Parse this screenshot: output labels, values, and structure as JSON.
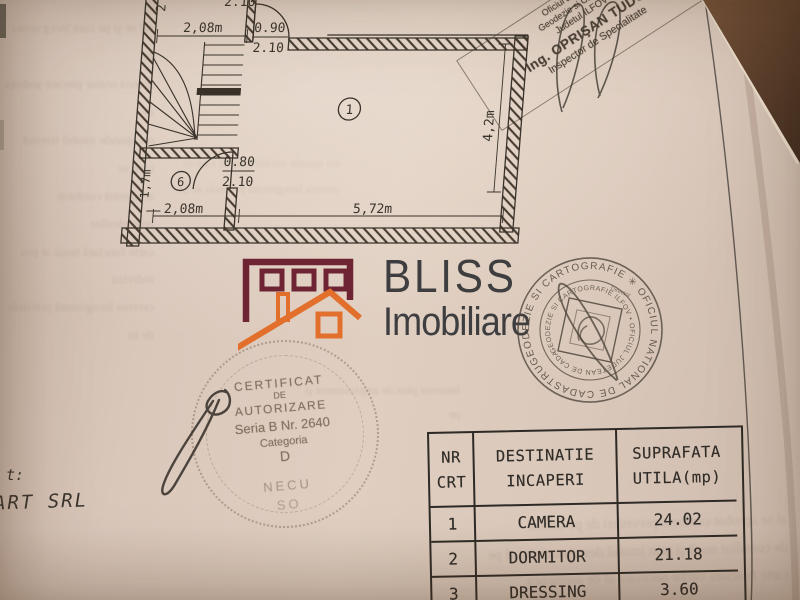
{
  "colors": {
    "paper": "#d8c6b8",
    "table_surface": "#5a3c28",
    "ink": "#3a332b",
    "logo_maroon": "#6e2433",
    "logo_orange": "#e2702c",
    "logo_text": "#3e3d3f"
  },
  "plan": {
    "dim_top_partial": "2.10",
    "dim_top_edge": "2",
    "dim_top_room": "2,08m",
    "door_top_w": "0.90",
    "door_top_h": "2.10",
    "door_hall_w": "0.80",
    "door_hall_h": "2.10",
    "dim_hall_height": "1,7m",
    "dim_bottom_left": "2,08m",
    "dim_bottom_right": "5,72m",
    "dim_right_height": "4,2m",
    "room1_label": "1",
    "room6_label": "6"
  },
  "inspector_stamp": {
    "line1": "Oficiul Judetean",
    "line2": "Geodezie si Cadastru",
    "line3": "Judetul ILFOV",
    "line4": "Ing. OPRIŞAN TUDOR",
    "line5": "Inspector de Specialitate"
  },
  "logo": {
    "brand": "BLISS",
    "subtitle": "Imobiliare"
  },
  "round_stamp": {
    "outer": "GEODEZIE SI CARTOGRAFIE ✳ OFICIUL NATIONAL DE CADASTRU ✳",
    "inner": "GEODEZIE SI CARTOGRAFIE ILFOV • OFICIUL JUDETEAN DE CADASTRU •",
    "director": "Director"
  },
  "certificate_stamp": {
    "l1": "CERTIFICAT",
    "l2": "DE",
    "l3": "AUTORIZARE",
    "l4": "Seria B Nr. 2640",
    "l5": "Categoria",
    "l6": "D",
    "name1": "NECU",
    "name2": "SO"
  },
  "footer": {
    "fragment1": "t:",
    "fragment2": "ART SRL"
  },
  "table": {
    "h1a": "NR",
    "h1b": "CRT",
    "h2a": "DESTINATIE",
    "h2b": "INCAPERI",
    "h3a": "SUPRAFATA",
    "h3b": "UTILA(mp)",
    "rows": [
      {
        "nr": "1",
        "dest": "CAMERA",
        "sup": "24.02"
      },
      {
        "nr": "2",
        "dest": "DORMITOR",
        "sup": "21.18"
      },
      {
        "nr": "3",
        "dest": "DRESSING",
        "sup": "3.60"
      }
    ]
  },
  "bleed_text_fragments_illegible": [
    "rul se şi pe care înreg strata pe",
    "menea orator plecare şedinţa de",
    "ori spunde imobil terenul care se",
    "se aprobă conform prevederilor",
    "carte funciară nouă al pro indiviza",
    "cererea înregistrată privinda de în",
    "al se aprobat conform prevederi de pe imobil",
    "de consiliul nouă şi prin imobil descris numita al pe",
    "carte funciara veche necesara al de asemenea",
    "întocmit plan de amplasament şi pe"
  ]
}
